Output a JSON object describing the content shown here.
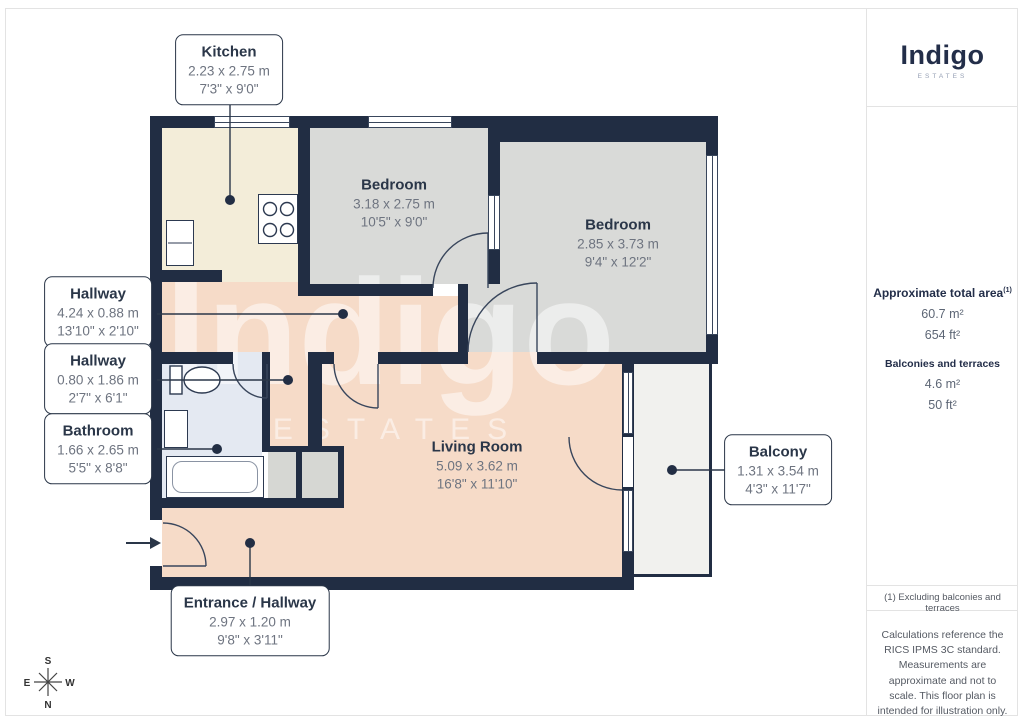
{
  "branding": {
    "logo_text": "Indigo",
    "logo_sub": "ESTATES"
  },
  "watermark": {
    "text": "Indigo",
    "sub": "ESTATES"
  },
  "sidebar": {
    "total_area_label": "Approximate total area",
    "total_area_sup": "(1)",
    "total_area_m": "60.7 m²",
    "total_area_ft": "654 ft²",
    "balconies_label": "Balconies and terraces",
    "balconies_m": "4.6 m²",
    "balconies_ft": "50 ft²",
    "footnote": "(1) Excluding balconies and terraces",
    "disclaimer": "Calculations reference the RICS IPMS 3C standard. Measurements are approximate and not to scale. This floor plan is intended for illustration only.",
    "provider": "GIRAFFE",
    "provider_bold": "360"
  },
  "compass": {
    "n": "N",
    "s": "S",
    "e": "E",
    "w": "W"
  },
  "rooms": [
    {
      "id": "kitchen",
      "name": "Kitchen",
      "metric": "2.23 x 2.75 m",
      "imperial": "7'3\" x 9'0\""
    },
    {
      "id": "bedroom1",
      "name": "Bedroom",
      "metric": "3.18 x 2.75 m",
      "imperial": "10'5\" x 9'0\""
    },
    {
      "id": "bedroom2",
      "name": "Bedroom",
      "metric": "2.85 x 3.73 m",
      "imperial": "9'4\" x 12'2\""
    },
    {
      "id": "hallway1",
      "name": "Hallway",
      "metric": "4.24 x 0.88 m",
      "imperial": "13'10\" x 2'10\""
    },
    {
      "id": "hallway2",
      "name": "Hallway",
      "metric": "0.80 x 1.86 m",
      "imperial": "2'7\" x 6'1\""
    },
    {
      "id": "bathroom",
      "name": "Bathroom",
      "metric": "1.66 x 2.65 m",
      "imperial": "5'5\" x 8'8\""
    },
    {
      "id": "living",
      "name": "Living Room",
      "metric": "5.09 x 3.62 m",
      "imperial": "16'8\" x 11'10\""
    },
    {
      "id": "balcony",
      "name": "Balcony",
      "metric": "1.31 x 3.54 m",
      "imperial": "4'3\" x 11'7\""
    },
    {
      "id": "entrance",
      "name": "Entrance / Hallway",
      "metric": "2.97 x 1.20 m",
      "imperial": "9'8\" x 3'11\""
    }
  ],
  "colors": {
    "wall": "#212d43",
    "kitchen_floor": "#f3edd9",
    "bedroom_floor": "#d9dad8",
    "hall_living_floor": "#f6dbc8",
    "bathroom_floor": "#e4e9f2",
    "balcony_floor": "#f1f1ee",
    "closet_floor": "#d6d7d3",
    "label_ink": "#2a3648",
    "dim_ink": "#6e7480"
  }
}
